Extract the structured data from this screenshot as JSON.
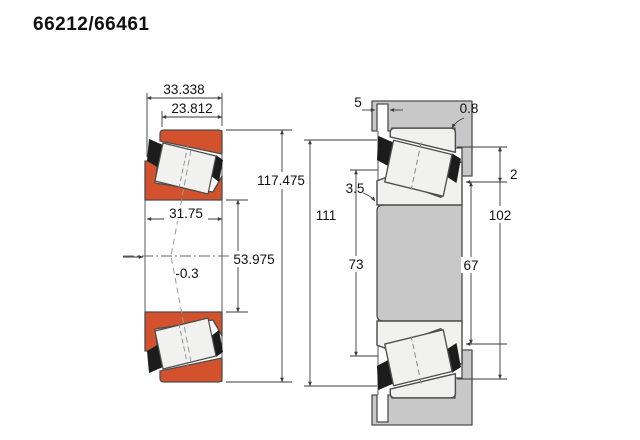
{
  "page": {
    "title": "66212/66461"
  },
  "left_view": {
    "description": "tapered roller bearing cross-section",
    "colors": {
      "ring": "#d4512e",
      "roller": "#f1f1ef",
      "cage": "#1c1c1c",
      "outline": "#4d4d4d"
    },
    "dimensions": {
      "overall_width": "33.338",
      "cup_width": "23.812",
      "outer_diameter": "117.475",
      "cone_width": "31.75",
      "bore_diameter": "53.975",
      "load_center_offset": "-0.3"
    }
  },
  "right_view": {
    "description": "mounted bearing arrangement with shaft and housing",
    "colors": {
      "metal": "#c8c8c8",
      "outline": "#555555"
    },
    "dimensions": {
      "face_offset": "5",
      "housing_fillet_radius": "0.8",
      "shaft_fillet_radius": "3.5",
      "backface_clearance": "2",
      "housing_shoulder_diameter": "111",
      "shaft_shoulder_diameter": "73",
      "housing_abutment_diameter": "102",
      "shaft_abutment_diameter": "67"
    }
  }
}
